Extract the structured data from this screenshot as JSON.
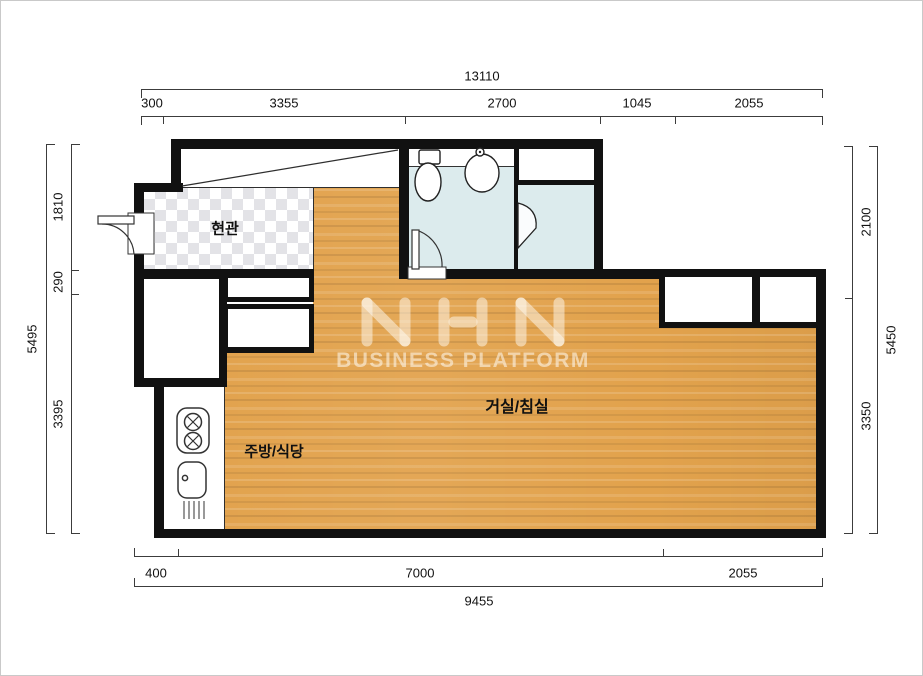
{
  "rooms": {
    "entrance": "현관",
    "kitchen": "주방/식당",
    "living": "거실/침실"
  },
  "dimensions": {
    "top": {
      "total": "13110",
      "segments": [
        "300",
        "3355",
        "2700",
        "1045",
        "2055"
      ]
    },
    "bottom": {
      "total": "9455",
      "segments": [
        "400",
        "7000",
        "2055"
      ]
    },
    "left": {
      "total": "5495",
      "segments": [
        "1810",
        "290",
        "3395"
      ]
    },
    "right": {
      "total": "5450",
      "segments": [
        "2100",
        "3350"
      ]
    }
  },
  "watermark": {
    "logo": "NHN",
    "subtitle": "BUSINESS PLATFORM"
  },
  "fixtures": [
    "toilet-icon",
    "bathroom-sink-icon",
    "stove-icon",
    "kitchen-sink-icon",
    "door-swing-icon"
  ],
  "colors": {
    "wall": "#111111",
    "wood": "#e2a24c",
    "bath": "#dcebed",
    "checker": "#e3e3e7"
  }
}
